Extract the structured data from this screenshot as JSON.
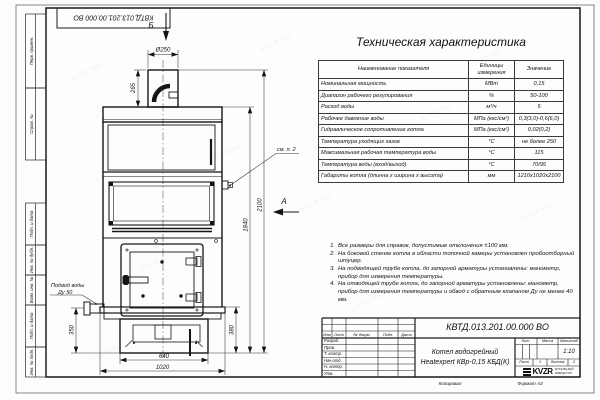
{
  "page": {
    "watermark": "KVZR.RU"
  },
  "frame": {
    "top_doc_box": "КВТД.013.201.00.000 ВО",
    "side_stamps": [
      "Перв. примен.",
      "Справ. №",
      "Подп. и дата",
      "Инв. № дубл.",
      "Взам. инв. №",
      "Подп. и дата",
      "Инв. № подл."
    ],
    "footer": {
      "copied": "Копировал",
      "format": "Формат А3"
    }
  },
  "drawing": {
    "section_arrow_top": "Б",
    "view_arrow_side": "А",
    "callout_note": "см. п. 2",
    "water_inlet": {
      "line1": "Подвод воды",
      "line2": "Ду 50"
    },
    "dims": {
      "chimney_dia": "Ø250",
      "chimney_h": "265",
      "total_h": "2100",
      "body_h": "1840",
      "inlet_h": "350",
      "base_h": "380",
      "base_w": "640",
      "total_w": "1020"
    }
  },
  "spec_table": {
    "title": "Техническая характеристика",
    "col_name": "Наименование показателя",
    "col_units": "Единицы измерения",
    "col_value": "Значение",
    "rows": [
      {
        "name": "Номинальная мощность",
        "units": "МВт",
        "value": "0,15"
      },
      {
        "name": "Диапазон рабочего регулирования",
        "units": "%",
        "value": "50-100"
      },
      {
        "name": "Расход воды",
        "units": "м³/ч",
        "value": "5"
      },
      {
        "name": "Рабочее давление воды",
        "units": "МПа (кгс/см²)",
        "value": "0,3(3,0)-0,6(6,0)"
      },
      {
        "name": "Гидравлическое сопротивление котла",
        "units": "МПа (кгс/см²)",
        "value": "0,02(0,2)"
      },
      {
        "name": "Температура уходящих газов",
        "units": "°С",
        "value": "не более 250"
      },
      {
        "name": "Максимальная рабочая температура воды",
        "units": "°С",
        "value": "115"
      },
      {
        "name": "Температура воды (вход/выход)",
        "units": "°С",
        "value": "70/95"
      },
      {
        "name": "Габариты котла (длинна х ширина х высота)",
        "units": "мм",
        "value": "1210х1020х2100"
      }
    ]
  },
  "notes": [
    {
      "num": "1.",
      "text": "Все размеры для справок, допустимые отклонения ±100 мм."
    },
    {
      "num": "2.",
      "text": "На боковой стенке котла в области топочной камеры установлен пробоотборный штуцер."
    },
    {
      "num": "3.",
      "text": "На подводящей трубе котла, до запорной арматуры установлены: манометр, прибор для измерения температуры."
    },
    {
      "num": "4.",
      "text": "На отводящей трубе котла, до запорной арматуры установлены: манометр, прибор для измерения температуры и обвод с обратным клапаном Ду не менее 40 мм."
    }
  ],
  "title_block": {
    "doc_number": "КВТД.013.201.00.000 ВО",
    "header_cols": [
      "Изм",
      "Лист",
      "№ докум.",
      "Подп.",
      "Дата"
    ],
    "roles": [
      "Разраб.",
      "Пров.",
      "Т. контр.",
      "Нач.отд",
      "Н. контр.",
      "Утв."
    ],
    "product_line1": "Котел водогрейный",
    "product_line2": "Heatexpert КВр-0,15 КБД(К)",
    "lit_label": "Лит.",
    "mass_label": "Масса",
    "scale_label": "Масштаб",
    "scale_value": "1:10",
    "sheet_label": "Лист",
    "sheet_value": "1",
    "sheets_label": "Листов",
    "sheets_value": "2",
    "logo_text": "KVZR",
    "company_line1": "КОТЕЛЬНЫЙ",
    "company_line2": "ЗАВОД РЭП"
  }
}
